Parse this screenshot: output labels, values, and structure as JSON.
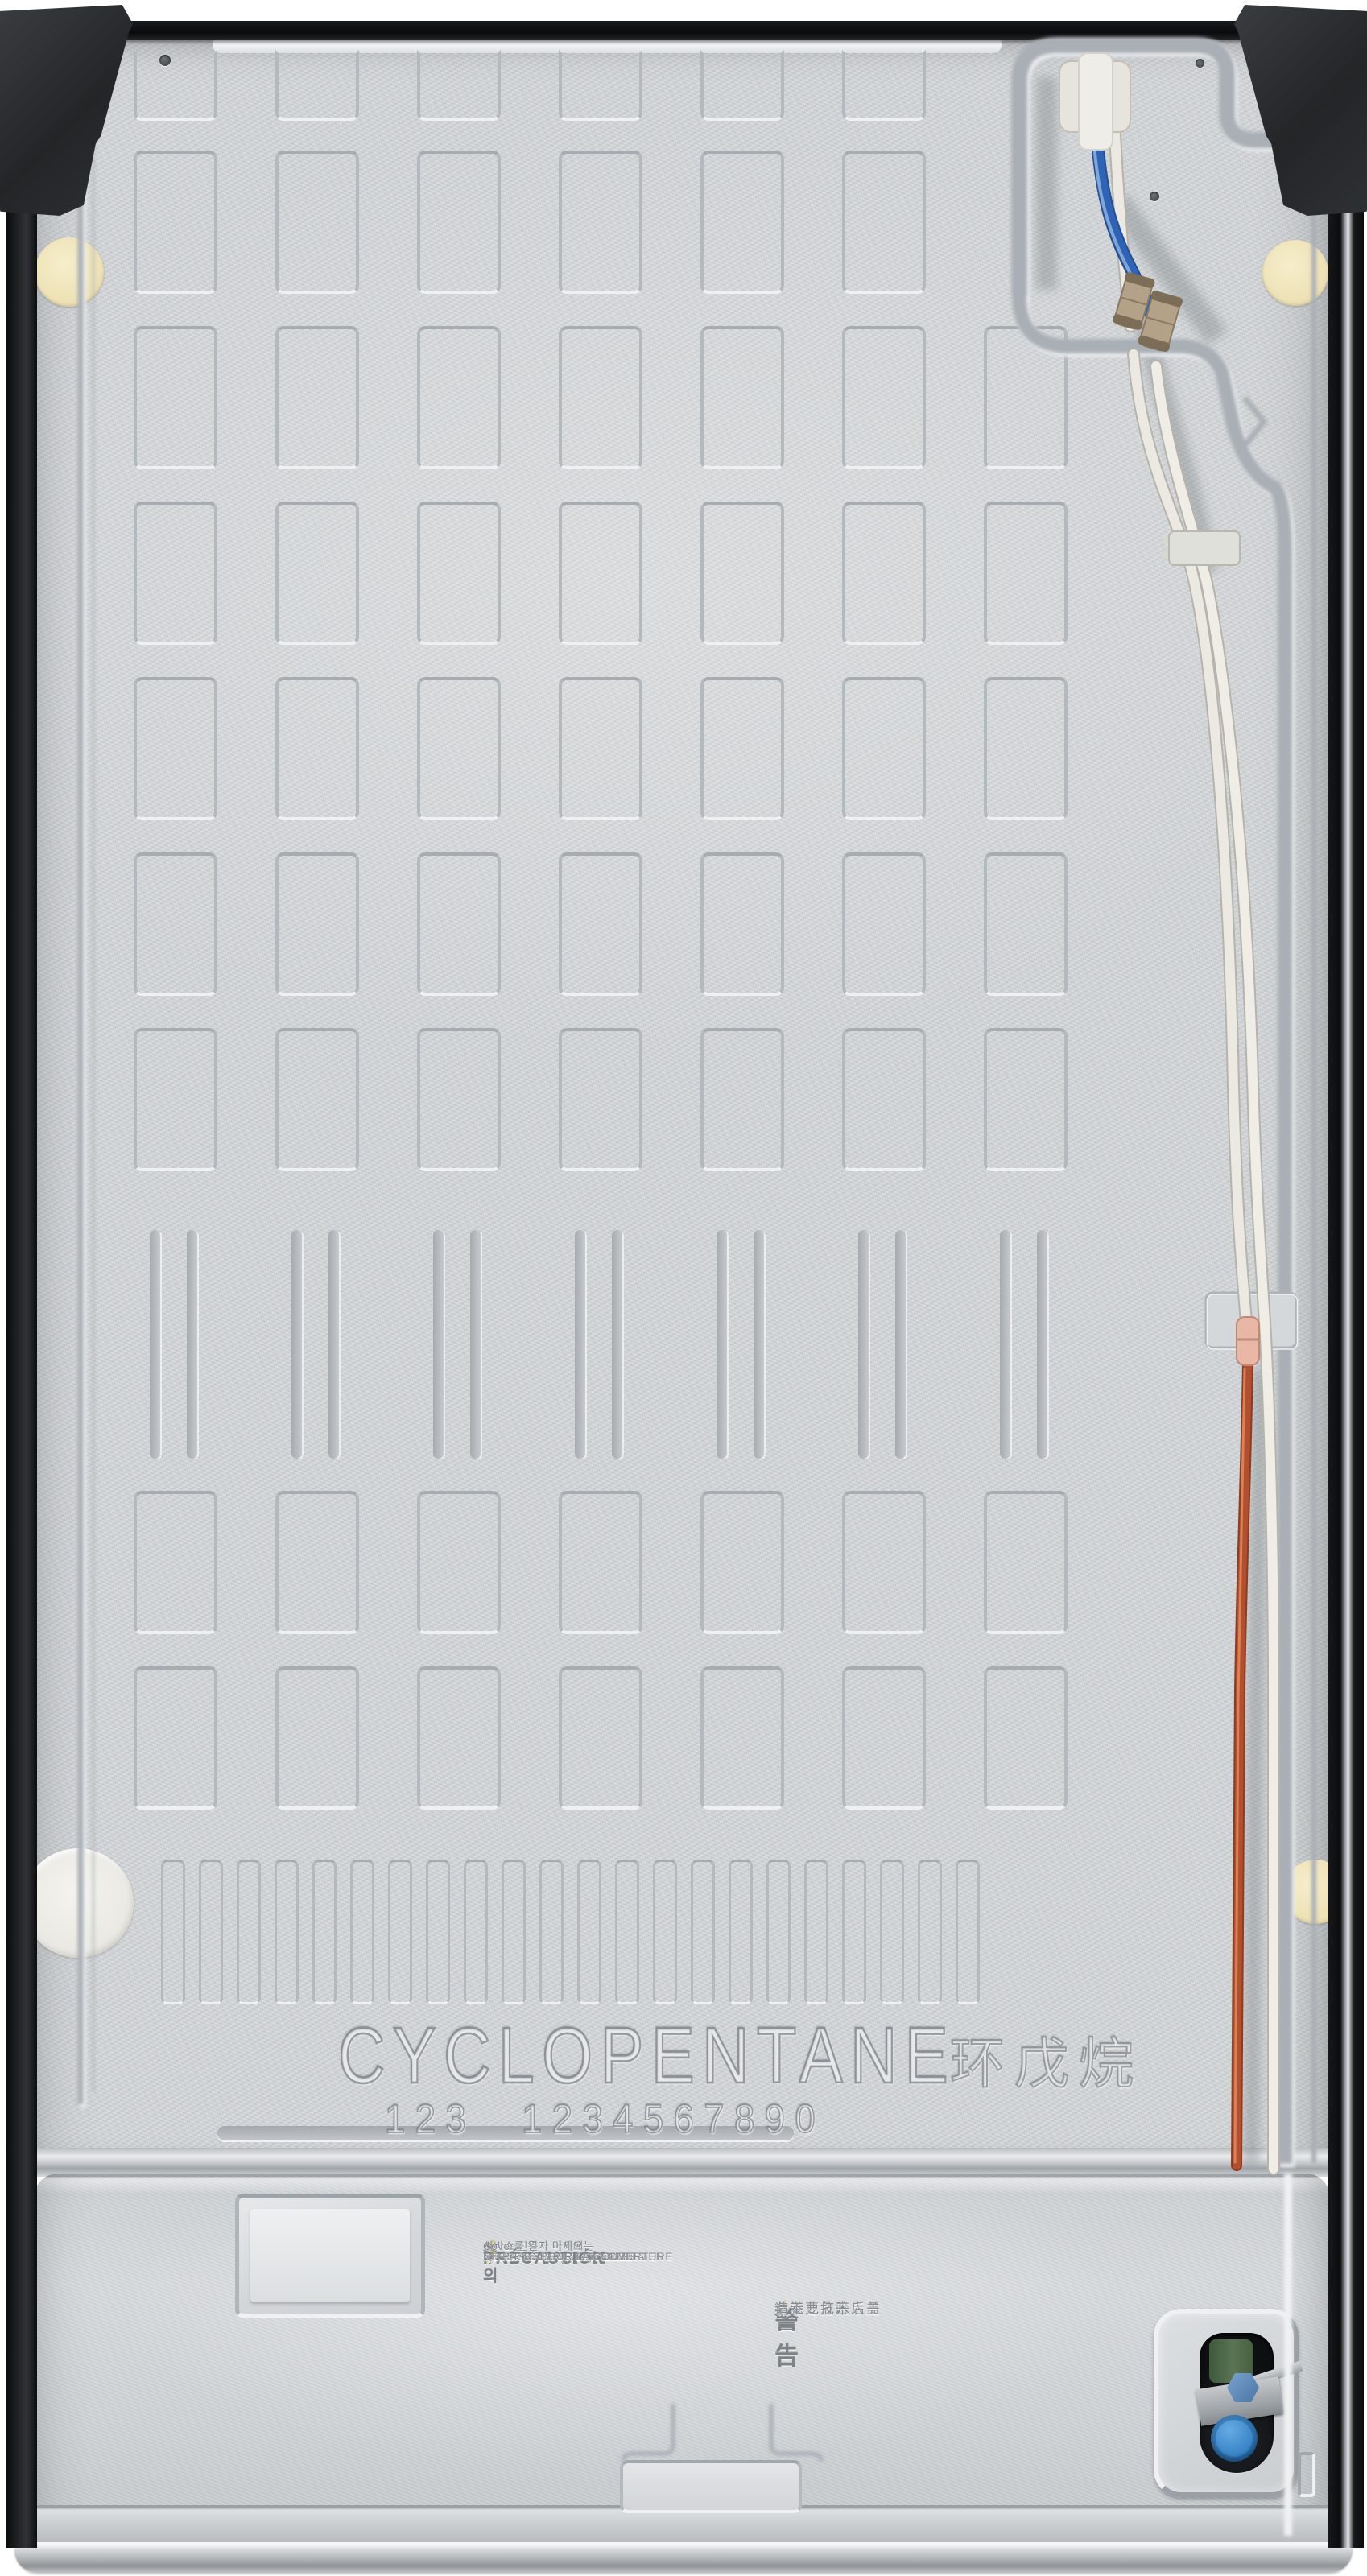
{
  "scene": {
    "subject": "Rear view of a refrigerator back panel",
    "note": "textured galvanized steel panel with embossed pattern, water tubing and compressor cover"
  },
  "icons": {
    "high_voltage": "⚡",
    "warning": "⚠"
  },
  "embossing": {
    "refrigerant": "CYCLOPENTANE",
    "refrigerant_cn": "环戊烷",
    "digits_left": "123",
    "digits_right": "1234567890"
  },
  "warning_labels": {
    "korean": {
      "title": "주 의",
      "lines": [
        "서비스 전문가 이외에는",
        "Cover를 열지 마세요"
      ]
    },
    "english": {
      "title": "CAUTION",
      "lines": [
        "EXCEPT FOR TECHNICIAN",
        "DO NOT OPEN THIS COVER"
      ]
    },
    "spanish": {
      "title": "PRECAUCIÓN",
      "lines": [
        "SÓLO PERSONAL TÉCNICO",
        "DEBE ABRIR ESTA CUBIERTA"
      ]
    },
    "french": {
      "title": "PRÉCAUTION",
      "lines": [
        "EXCEPTÉ POUR LE TECHNICIEN",
        "NE PAS OUVRIR LA COUVERTURE"
      ]
    },
    "chinese": {
      "title": "警 告",
      "lines": [
        "有触电危险",
        "非专业技术人员",
        "请不要打开后盖"
      ]
    }
  },
  "colors": {
    "panel": "#d6d9db",
    "edge_black": "#0d0e0f",
    "vent_slot": "#1a1c1e",
    "tube_blue": "#2f63b5",
    "tube_white": "#ece9e2",
    "tube_copper": "#b0502e",
    "coupler_tan": "#b3a188",
    "valve_green": "#50694a",
    "valve_cap_blue": "#3e8ed0",
    "plug_cream": "#f0e7c2",
    "sticker_white": "#edece7"
  }
}
